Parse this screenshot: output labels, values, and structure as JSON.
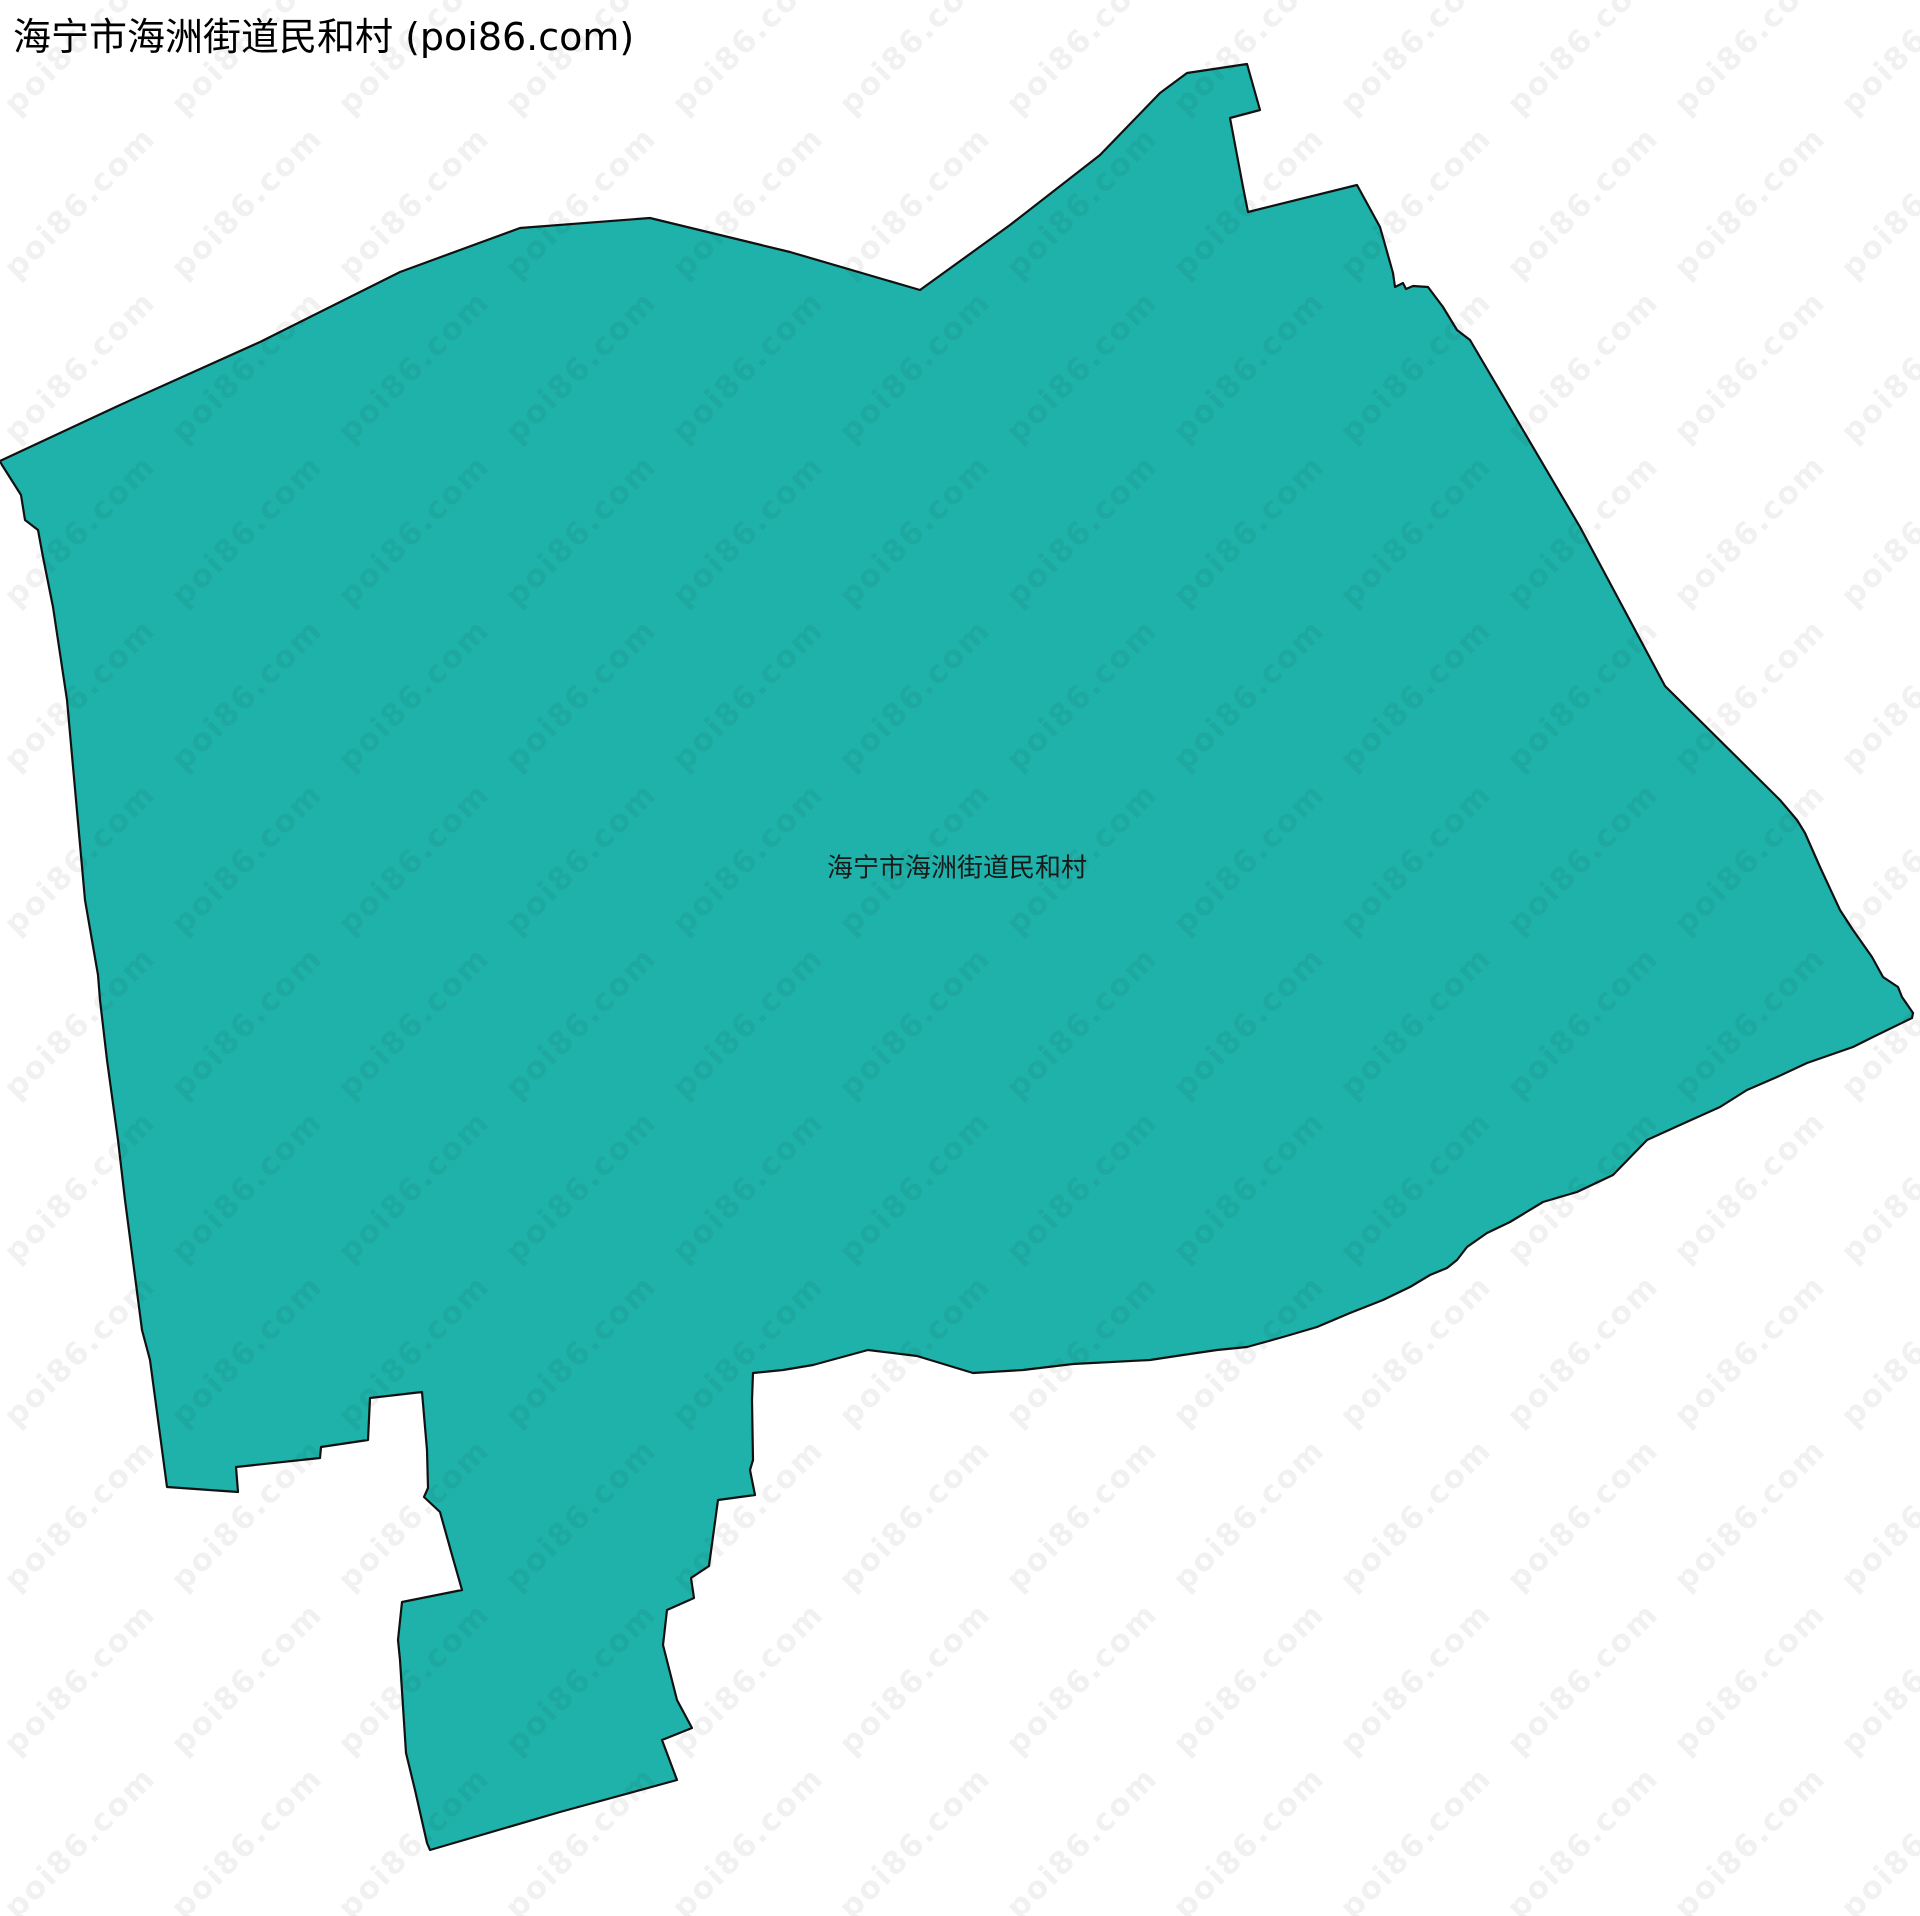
{
  "page": {
    "title": "海宁市海洲街道民和村 (poi86.com)"
  },
  "map": {
    "region_label": "海宁市海洲街道民和村",
    "fill_color": "#1FB2AA",
    "stroke_color": "#111111",
    "stroke_width": 2.2,
    "canvas_width": 1920,
    "canvas_height": 1916,
    "polygon_points": [
      [
        0,
        461
      ],
      [
        120,
        405
      ],
      [
        260,
        342
      ],
      [
        400,
        272
      ],
      [
        520,
        228
      ],
      [
        650,
        218
      ],
      [
        790,
        252
      ],
      [
        920,
        290
      ],
      [
        1010,
        225
      ],
      [
        1100,
        155
      ],
      [
        1160,
        93
      ],
      [
        1187,
        73
      ],
      [
        1247,
        64
      ],
      [
        1260,
        110
      ],
      [
        1230,
        118
      ],
      [
        1243,
        187
      ],
      [
        1248,
        212
      ],
      [
        1357,
        185
      ],
      [
        1380,
        227
      ],
      [
        1393,
        273
      ],
      [
        1395,
        287
      ],
      [
        1403,
        283
      ],
      [
        1406,
        289
      ],
      [
        1413,
        286
      ],
      [
        1428,
        287
      ],
      [
        1443,
        307
      ],
      [
        1457,
        330
      ],
      [
        1470,
        340
      ],
      [
        1580,
        527
      ],
      [
        1665,
        686
      ],
      [
        1780,
        800
      ],
      [
        1797,
        820
      ],
      [
        1805,
        833
      ],
      [
        1820,
        867
      ],
      [
        1840,
        910
      ],
      [
        1853,
        930
      ],
      [
        1872,
        957
      ],
      [
        1883,
        977
      ],
      [
        1898,
        987
      ],
      [
        1902,
        997
      ],
      [
        1913,
        1013
      ],
      [
        1912,
        1018
      ],
      [
        1873,
        1037
      ],
      [
        1853,
        1047
      ],
      [
        1807,
        1063
      ],
      [
        1777,
        1077
      ],
      [
        1747,
        1090
      ],
      [
        1720,
        1107
      ],
      [
        1680,
        1125
      ],
      [
        1647,
        1140
      ],
      [
        1613,
        1175
      ],
      [
        1577,
        1192
      ],
      [
        1543,
        1202
      ],
      [
        1510,
        1222
      ],
      [
        1487,
        1233
      ],
      [
        1467,
        1247
      ],
      [
        1457,
        1260
      ],
      [
        1447,
        1268
      ],
      [
        1430,
        1275
      ],
      [
        1410,
        1287
      ],
      [
        1383,
        1300
      ],
      [
        1350,
        1313
      ],
      [
        1317,
        1327
      ],
      [
        1283,
        1337
      ],
      [
        1247,
        1347
      ],
      [
        1217,
        1350
      ],
      [
        1183,
        1355
      ],
      [
        1150,
        1360
      ],
      [
        1073,
        1364
      ],
      [
        1023,
        1370
      ],
      [
        973,
        1373
      ],
      [
        917,
        1356
      ],
      [
        868,
        1350
      ],
      [
        813,
        1365
      ],
      [
        783,
        1370
      ],
      [
        753,
        1373
      ],
      [
        752,
        1400
      ],
      [
        753,
        1460
      ],
      [
        750,
        1470
      ],
      [
        755,
        1495
      ],
      [
        718,
        1500
      ],
      [
        709,
        1566
      ],
      [
        691,
        1578
      ],
      [
        694,
        1598
      ],
      [
        667,
        1610
      ],
      [
        663,
        1645
      ],
      [
        677,
        1700
      ],
      [
        692,
        1728
      ],
      [
        662,
        1740
      ],
      [
        677,
        1780
      ],
      [
        560,
        1812
      ],
      [
        430,
        1850
      ],
      [
        427,
        1843
      ],
      [
        415,
        1790
      ],
      [
        406,
        1753
      ],
      [
        400,
        1660
      ],
      [
        398,
        1640
      ],
      [
        402,
        1602
      ],
      [
        462,
        1590
      ],
      [
        452,
        1555
      ],
      [
        440,
        1512
      ],
      [
        424,
        1497
      ],
      [
        428,
        1488
      ],
      [
        427,
        1450
      ],
      [
        422,
        1392
      ],
      [
        370,
        1398
      ],
      [
        368,
        1440
      ],
      [
        321,
        1447
      ],
      [
        320,
        1458
      ],
      [
        236,
        1467
      ],
      [
        238,
        1492
      ],
      [
        167,
        1487
      ],
      [
        150,
        1360
      ],
      [
        142,
        1330
      ],
      [
        125,
        1200
      ],
      [
        118,
        1140
      ],
      [
        107,
        1060
      ],
      [
        100,
        1000
      ],
      [
        98,
        975
      ],
      [
        85,
        900
      ],
      [
        67,
        700
      ],
      [
        53,
        607
      ],
      [
        43,
        557
      ],
      [
        38,
        530
      ],
      [
        25,
        520
      ],
      [
        21,
        495
      ],
      [
        2,
        465
      ]
    ]
  },
  "watermark": {
    "text": "poi86.com",
    "color": "rgba(0,0,0,0.055)",
    "rotation_deg": -45,
    "origin_x": 80,
    "origin_y": 39,
    "spacing_x": 167,
    "spacing_y": 164,
    "cols": 12,
    "rows": 12
  }
}
